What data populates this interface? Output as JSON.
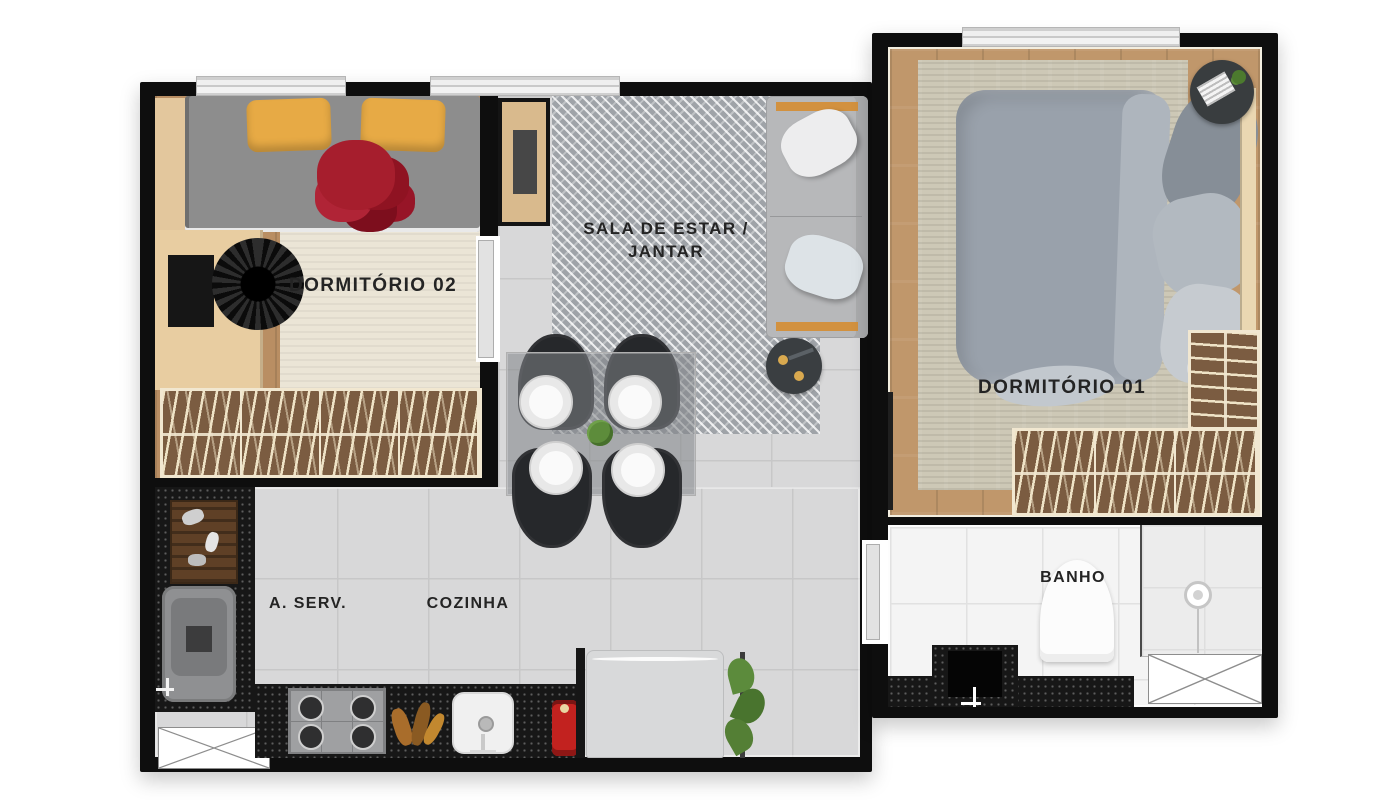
{
  "plan": {
    "type": "apartment-floor-plan",
    "rooms": {
      "dormitorio_02": {
        "label": "DORMITÓRIO 02"
      },
      "sala": {
        "label_line1": "SALA DE ESTAR /",
        "label_line2": "JANTAR"
      },
      "dormitorio_01": {
        "label": "DORMITÓRIO 01"
      },
      "area_servico": {
        "label": "A. SERV."
      },
      "cozinha": {
        "label": "COZINHA"
      },
      "banho": {
        "label": "BANHO"
      }
    },
    "colors": {
      "wall": "#0e0e0e",
      "tile_floor": "#d8d8d9",
      "bath_tile": "#f4f4f4",
      "wood_floor": "#c0976b",
      "rug_beige": "#ebe5d6",
      "rug_living_gray": "#9fa3a8",
      "counter_black": "#171717",
      "pillow_yellow": "#e7aa45",
      "sofa_trim_orange": "#d2913f",
      "blanket_red": "#a61e2d",
      "sofa_gray": "#b7b8ba",
      "duvet_gray": "#99a1ab",
      "coffee_machine_red": "#c2221f"
    },
    "furniture_depicted": [
      "single-bed",
      "desk",
      "desk-chair",
      "wardrobes",
      "tv-cabinet",
      "sofa",
      "coffee-table",
      "dining-table",
      "dining-chairs",
      "stove",
      "kitchen-sink",
      "fridge",
      "washing-machine",
      "coffee-machine",
      "double-bed",
      "nightstand",
      "toilet",
      "bathroom-sink",
      "shower"
    ]
  }
}
